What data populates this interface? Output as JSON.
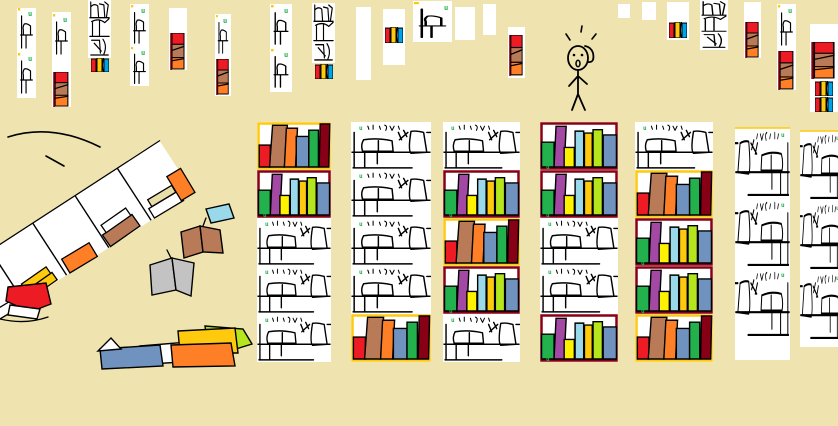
{
  "scene": {
    "width": 838,
    "height": 426,
    "description": "hand-drawn library scene with bookshelves, fallen bookcase, scattered books and a surprised stick figure"
  },
  "palette": {
    "background": "#EFE4B0",
    "paper": "#FFFFFF",
    "ink": "#000000",
    "red": "#ED1C24",
    "orange": "#FF7F27",
    "yellow": "#FFF200",
    "gold": "#FFC90E",
    "green": "#22B14C",
    "lime": "#B5E61D",
    "lightblue": "#99D9EA",
    "bluegray": "#7092BE",
    "blue": "#00A2E8",
    "purple": "#A349A4",
    "darkred": "#880015",
    "brown": "#B97A57",
    "gray": "#C3C3C3",
    "tanbook": "#E8DCA8",
    "white": "#FFFFFF"
  },
  "marker": {
    "glyph": "u",
    "color_key": "green"
  },
  "shelf_sets": {
    "warm": {
      "border_key": "gold",
      "books": [
        "red",
        "brown",
        "orange",
        "bluegray",
        "green",
        "darkred"
      ]
    },
    "cool": {
      "border_key": "darkred",
      "books": [
        "green",
        "purple",
        "yellow",
        "lightblue",
        "gold",
        "lime",
        "bluegray"
      ]
    }
  },
  "background_strips": [
    {
      "x": 17,
      "y": 8,
      "w": 19,
      "h": 90,
      "items": [
        {
          "t": "cell",
          "dy": 0,
          "h": 44
        },
        {
          "t": "cell",
          "dy": 45,
          "h": 44
        }
      ]
    },
    {
      "x": 52,
      "y": 12,
      "w": 19,
      "h": 95,
      "items": [
        {
          "t": "cell",
          "dy": 2,
          "h": 44
        },
        {
          "t": "rbo",
          "dy": 60,
          "h": 35
        }
      ]
    },
    {
      "x": 88,
      "y": 0,
      "w": 23,
      "h": 58,
      "items": [
        {
          "t": "dense",
          "dy": 0,
          "h": 57
        }
      ]
    },
    {
      "x": 90,
      "y": 58,
      "w": 20,
      "h": 14,
      "bare": true,
      "items": [
        {
          "t": "ryb",
          "dy": 0,
          "h": 14
        }
      ]
    },
    {
      "x": 130,
      "y": 4,
      "w": 19,
      "h": 82,
      "items": [
        {
          "t": "cell",
          "dy": 1,
          "h": 42
        },
        {
          "t": "cell",
          "dy": 43,
          "h": 40
        }
      ]
    },
    {
      "x": 169,
      "y": 8,
      "w": 18,
      "h": 62,
      "items": [
        {
          "t": "rbo",
          "dy": 25,
          "h": 37
        }
      ]
    },
    {
      "x": 215,
      "y": 14,
      "w": 16,
      "h": 82,
      "items": [
        {
          "t": "cell",
          "dy": 1,
          "h": 42
        },
        {
          "t": "rbo",
          "dy": 45,
          "h": 36
        }
      ]
    },
    {
      "x": 270,
      "y": 4,
      "w": 22,
      "h": 88,
      "items": [
        {
          "t": "cell",
          "dy": 1,
          "h": 43
        },
        {
          "t": "cell",
          "dy": 45,
          "h": 42
        }
      ]
    },
    {
      "x": 312,
      "y": 3,
      "w": 23,
      "h": 60,
      "items": [
        {
          "t": "dense",
          "dy": 0,
          "h": 59
        }
      ]
    },
    {
      "x": 314,
      "y": 64,
      "w": 20,
      "h": 15,
      "bare": true,
      "items": [
        {
          "t": "ryb",
          "dy": 0,
          "h": 15
        }
      ]
    },
    {
      "x": 356,
      "y": 7,
      "w": 15,
      "h": 73,
      "items": []
    },
    {
      "x": 383,
      "y": 9,
      "w": 22,
      "h": 56,
      "items": [
        {
          "t": "ryb",
          "dy": 18,
          "h": 16
        }
      ]
    },
    {
      "x": 413,
      "y": 1,
      "w": 39,
      "h": 41,
      "items": [
        {
          "t": "cell",
          "dy": 1,
          "h": 39
        }
      ]
    },
    {
      "x": 455,
      "y": 7,
      "w": 20,
      "h": 33,
      "items": []
    },
    {
      "x": 483,
      "y": 4,
      "w": 13,
      "h": 31,
      "items": []
    },
    {
      "x": 508,
      "y": 27,
      "w": 17,
      "h": 51,
      "items": [
        {
          "t": "rbo",
          "dy": 8,
          "h": 41
        }
      ]
    },
    {
      "x": 618,
      "y": 4,
      "w": 12,
      "h": 14,
      "items": []
    },
    {
      "x": 642,
      "y": 2,
      "w": 14,
      "h": 18,
      "items": []
    },
    {
      "x": 667,
      "y": 2,
      "w": 22,
      "h": 38,
      "items": [
        {
          "t": "ryb",
          "dy": 20,
          "h": 16
        }
      ]
    },
    {
      "x": 700,
      "y": 0,
      "w": 28,
      "h": 50,
      "items": [
        {
          "t": "dense",
          "dy": 0,
          "h": 49
        }
      ]
    },
    {
      "x": 744,
      "y": 2,
      "w": 17,
      "h": 56,
      "items": [
        {
          "t": "rbo",
          "dy": 20,
          "h": 36
        }
      ]
    },
    {
      "x": 777,
      "y": 4,
      "w": 19,
      "h": 86,
      "items": [
        {
          "t": "cell",
          "dy": 1,
          "h": 44
        },
        {
          "t": "rbo",
          "dy": 47,
          "h": 39
        }
      ]
    },
    {
      "x": 810,
      "y": 24,
      "w": 28,
      "h": 88,
      "items": [
        {
          "t": "rbo",
          "dy": 18,
          "h": 37
        },
        {
          "t": "ryb",
          "dy": 57,
          "h": 15
        },
        {
          "t": "ryb",
          "dy": 73,
          "h": 15
        }
      ]
    }
  ],
  "bookcases": [
    {
      "x": 257,
      "y": 122,
      "w": 74,
      "rh": 48,
      "rows": [
        "warm",
        "cool",
        "outline",
        "outline",
        "outline"
      ]
    },
    {
      "x": 351,
      "y": 122,
      "w": 80,
      "rh": 48,
      "rows": [
        "outline",
        "outline",
        "outline",
        "outline",
        "warm"
      ]
    },
    {
      "x": 443,
      "y": 122,
      "w": 77,
      "rh": 48,
      "rows": [
        "outline",
        "cool",
        "warm",
        "cool",
        "outline"
      ]
    },
    {
      "x": 540,
      "y": 122,
      "w": 78,
      "rh": 48,
      "rows": [
        "cool",
        "cool",
        "outline",
        "outline",
        "cool"
      ]
    },
    {
      "x": 635,
      "y": 122,
      "w": 78,
      "rh": 48,
      "rows": [
        "outline",
        "warm",
        "cool",
        "cool",
        "warm"
      ]
    }
  ],
  "side_bookcases": [
    {
      "x": 735,
      "y": 128,
      "w": 55,
      "rh": 70,
      "rows": 3,
      "pad_bottom": 22
    },
    {
      "x": 800,
      "y": 131,
      "w": 45,
      "rh": 70,
      "rows": 3,
      "pad_bottom": 6
    }
  ],
  "fallen_case": {
    "x": -18,
    "y": 330,
    "angle": -33,
    "len": 252,
    "depth": 62,
    "cells": 5,
    "books": [
      {
        "cell": 0,
        "color": "white",
        "dx": 6,
        "w": 34,
        "h": 10,
        "lift": 0
      },
      {
        "cell": 1,
        "color": "gold",
        "dx": 4,
        "w": 36,
        "h": 9,
        "lift": 0
      },
      {
        "cell": 1,
        "color": "gold",
        "dx": 8,
        "w": 30,
        "h": 8,
        "lift": 9
      },
      {
        "cell": 2,
        "color": "orange",
        "dx": 4,
        "w": 32,
        "h": 16,
        "lift": 0
      },
      {
        "cell": 3,
        "color": "brown",
        "dx": 2,
        "w": 36,
        "h": 14,
        "lift": 0
      },
      {
        "cell": 3,
        "color": "white",
        "dx": 6,
        "w": 30,
        "h": 9,
        "lift": 14
      },
      {
        "cell": 4,
        "color": "white",
        "dx": 4,
        "w": 34,
        "h": 11,
        "lift": 0
      },
      {
        "cell": 4,
        "color": "tanbook",
        "dx": 8,
        "w": 28,
        "h": 8,
        "lift": 11
      },
      {
        "cell": 4,
        "color": "orange",
        "dx": 36,
        "w": 16,
        "h": 28,
        "lift": 0
      }
    ]
  },
  "floor_books": [
    {
      "id": "floor-book-lightblue",
      "polys": [
        {
          "color": "lightblue",
          "pts": "206,209 229,204 234,218 211,223"
        }
      ],
      "lines": []
    },
    {
      "id": "floor-book-brown-open",
      "polys": [
        {
          "color": "brown",
          "pts": "181,232 200,226 203,252 184,258"
        },
        {
          "color": "brown",
          "pts": "200,226 220,230 223,253 203,252"
        }
      ],
      "lines": [
        "M203,226 l3,-8"
      ]
    },
    {
      "id": "floor-book-gray-open",
      "polys": [
        {
          "color": "gray",
          "pts": "150,265 172,258 176,290 152,295"
        },
        {
          "color": "gray",
          "pts": "172,258 194,263 191,296 176,290"
        }
      ],
      "lines": [
        "M171,258 l-4,-8"
      ]
    },
    {
      "id": "floor-book-red",
      "polys": [
        {
          "color": "red",
          "pts": "8,287 46,283 51,304 30,312 6,301"
        },
        {
          "color": "white",
          "pts": "10,305 40,309 37,319 8,315"
        }
      ],
      "lines": [
        "M0,319 q25,6 48,-2"
      ]
    },
    {
      "id": "floor-book-blue",
      "polys": [
        {
          "color": "white",
          "pts": "140,346 188,342 183,362 150,364"
        },
        {
          "color": "bluegray",
          "pts": "100,349 160,345 163,366 102,369"
        },
        {
          "color": "white",
          "pts": "98,351 111,338 121,349"
        }
      ],
      "lines": []
    },
    {
      "id": "floor-book-stack",
      "polys": [
        {
          "color": "lime",
          "pts": "205,326 243,329 252,344 226,352 208,349"
        },
        {
          "color": "gold",
          "pts": "178,331 235,328 238,353 180,353"
        },
        {
          "color": "orange",
          "pts": "171,345 231,343 235,366 173,367"
        }
      ],
      "lines": []
    }
  ],
  "motion_lines": [
    "M8,137 Q52,123 100,147",
    "M46,156 Q55,161 64,166"
  ],
  "figure": {
    "x": 548,
    "y": 26,
    "pose": "surprised"
  }
}
